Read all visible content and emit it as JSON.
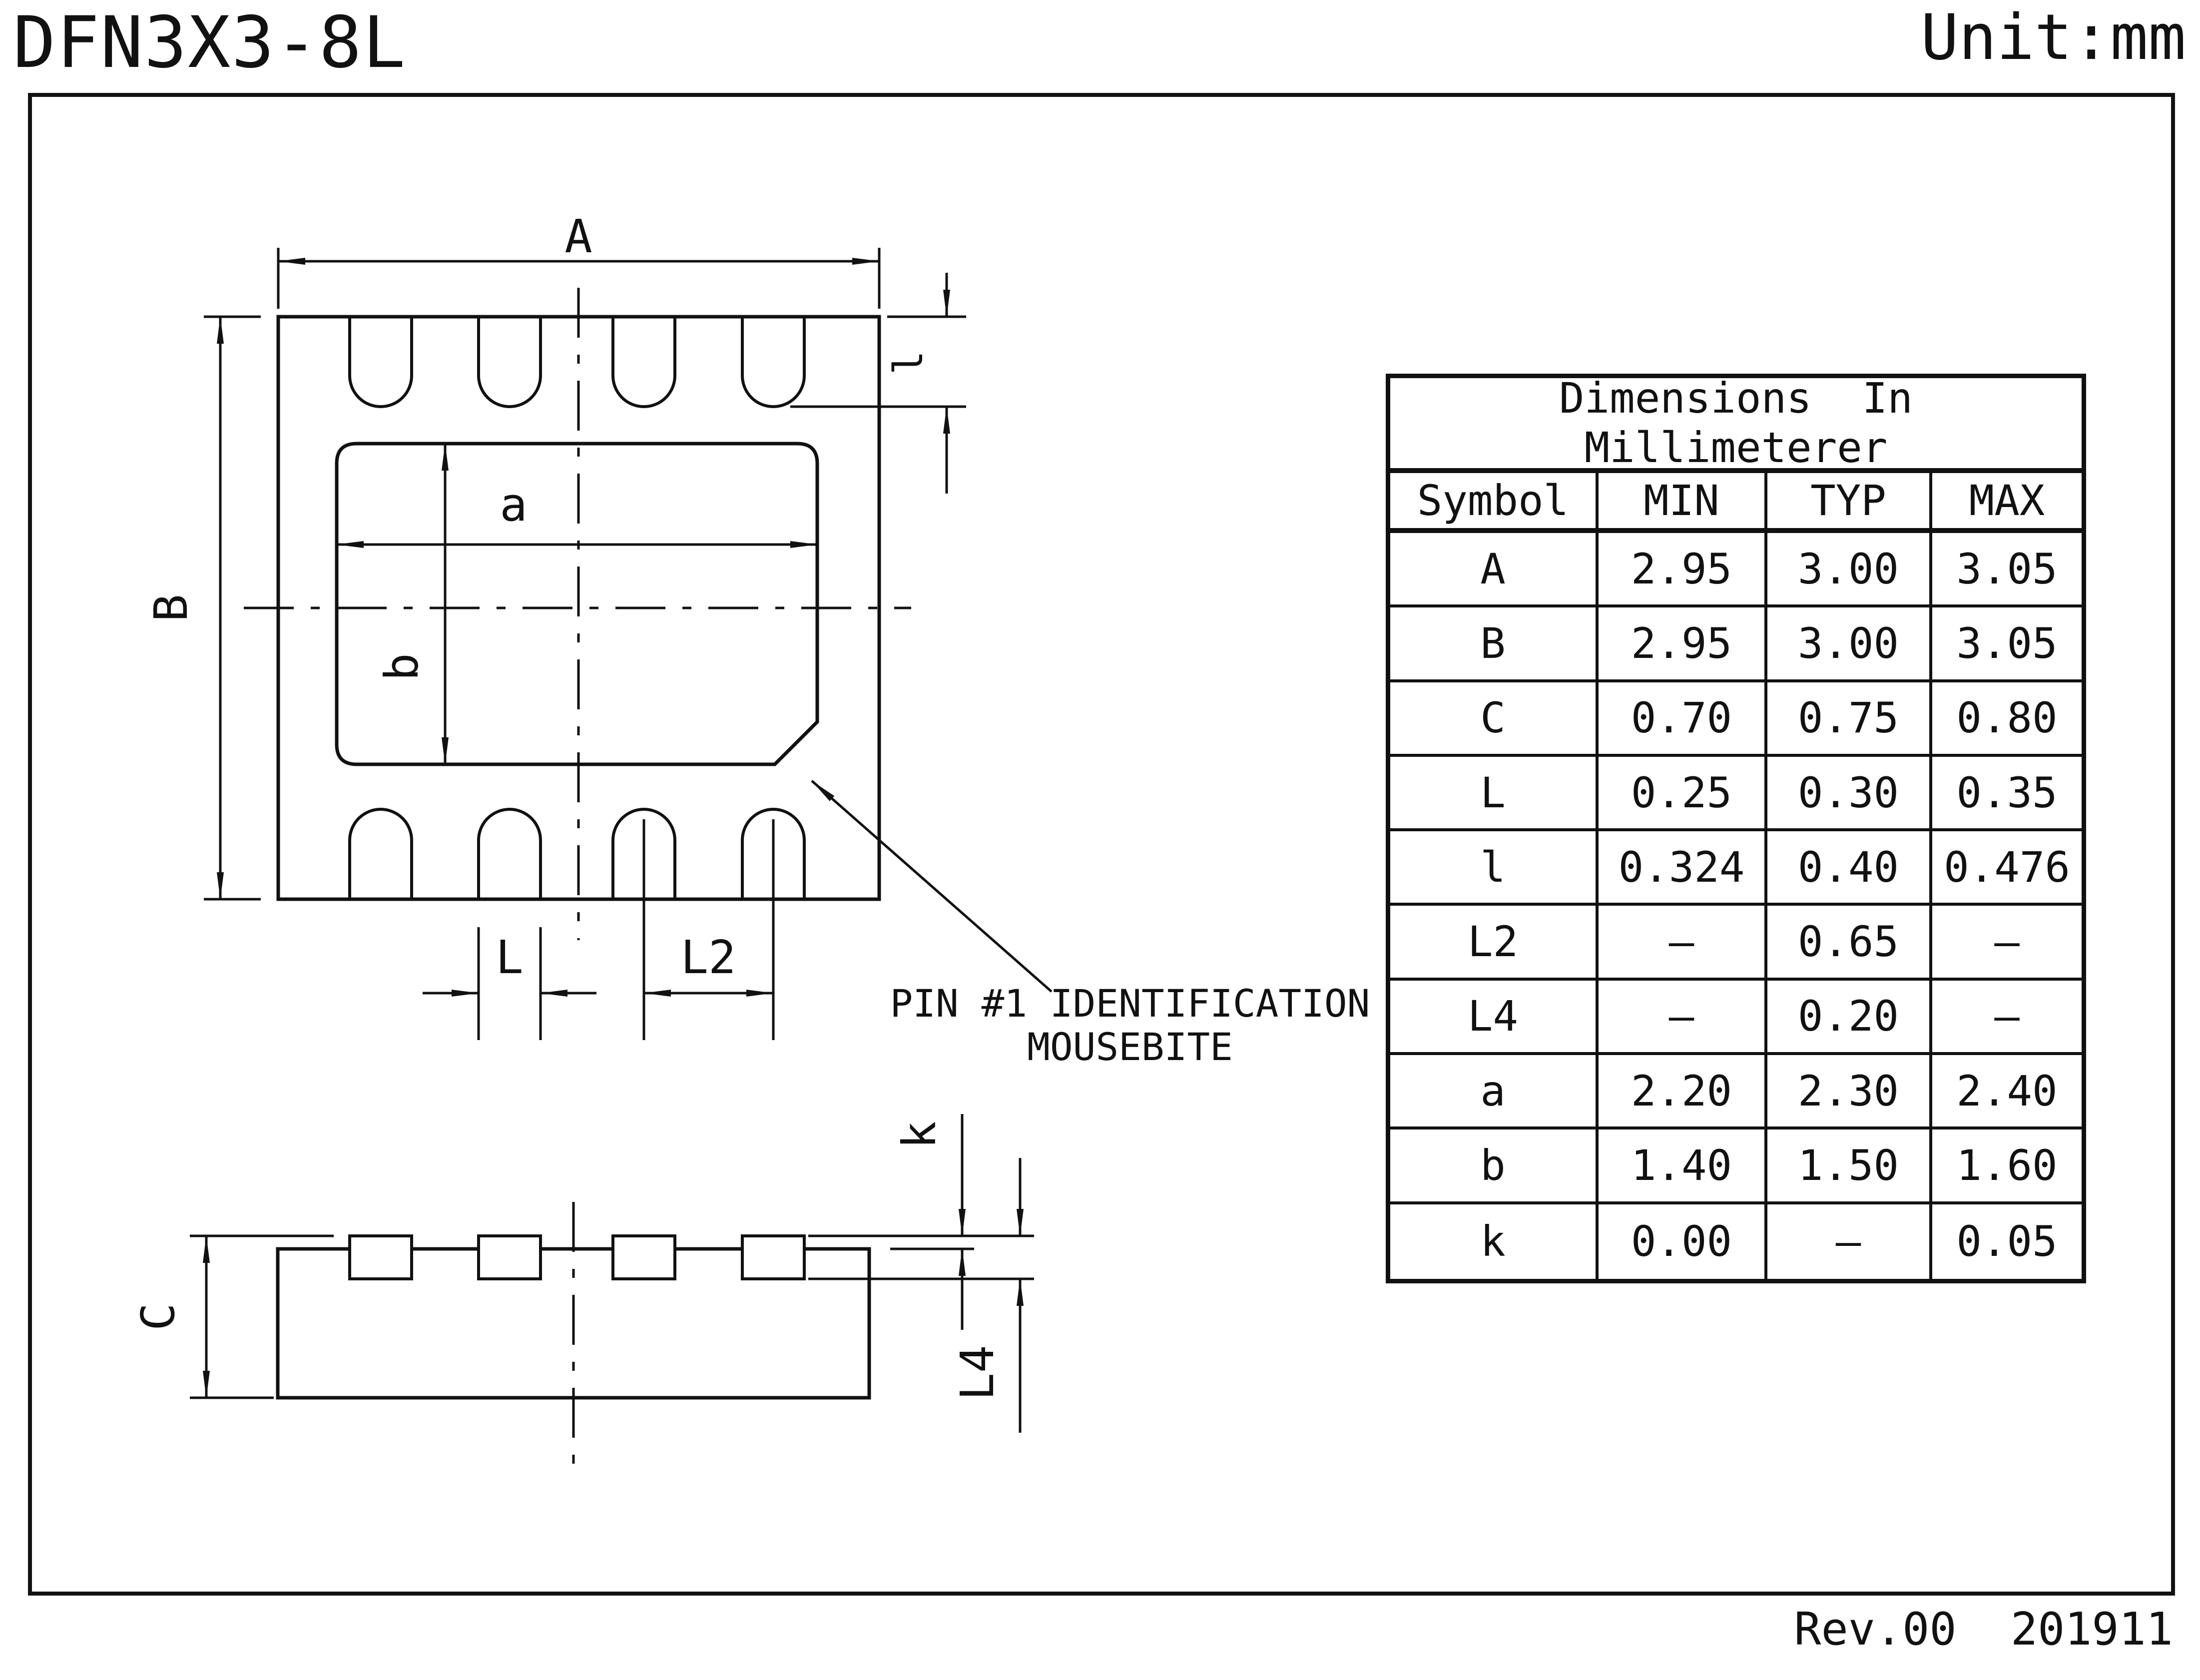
{
  "title": "DFN3X3-8L",
  "unit": "Unit:mm",
  "footer": "Rev.00  201911",
  "note": {
    "line1": "PIN #1 IDENTIFICATION",
    "line2": "MOUSEBITE"
  },
  "dims": {
    "A": "A",
    "B": "B",
    "a": "a",
    "b": "b",
    "l": "l",
    "L": "L",
    "L2": "L2",
    "C": "C",
    "k": "k",
    "L4": "L4"
  },
  "table": {
    "title_line1": "Dimensions  In",
    "title_line2": "Millimeterer",
    "headers": [
      "Symbol",
      "MIN",
      "TYP",
      "MAX"
    ],
    "rows": [
      [
        "A",
        "2.95",
        "3.00",
        "3.05"
      ],
      [
        "B",
        "2.95",
        "3.00",
        "3.05"
      ],
      [
        "C",
        "0.70",
        "0.75",
        "0.80"
      ],
      [
        "L",
        "0.25",
        "0.30",
        "0.35"
      ],
      [
        "l",
        "0.324",
        "0.40",
        "0.476"
      ],
      [
        "L2",
        "–",
        "0.65",
        "–"
      ],
      [
        "L4",
        "–",
        "0.20",
        "–"
      ],
      [
        "a",
        "2.20",
        "2.30",
        "2.40"
      ],
      [
        "b",
        "1.40",
        "1.50",
        "1.60"
      ],
      [
        "k",
        "0.00",
        "–",
        "0.05"
      ]
    ]
  },
  "colors": {
    "ink": "#111111",
    "background": "#ffffff"
  }
}
